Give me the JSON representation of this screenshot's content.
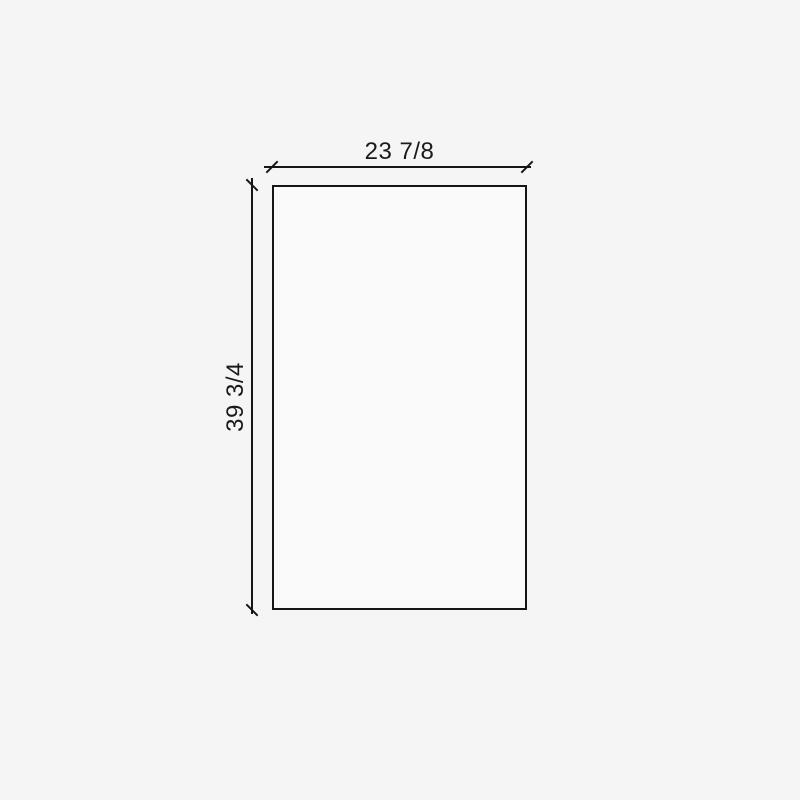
{
  "drawing": {
    "type": "dimensioned-panel-drawing",
    "width_dimension": {
      "label": "23 7/8"
    },
    "height_dimension": {
      "label": "39 3/4"
    }
  },
  "colors": {
    "background": "#f5f5f6",
    "line": "#161616",
    "text": "#1a1a1a",
    "panel_fill": "#fafafa"
  }
}
